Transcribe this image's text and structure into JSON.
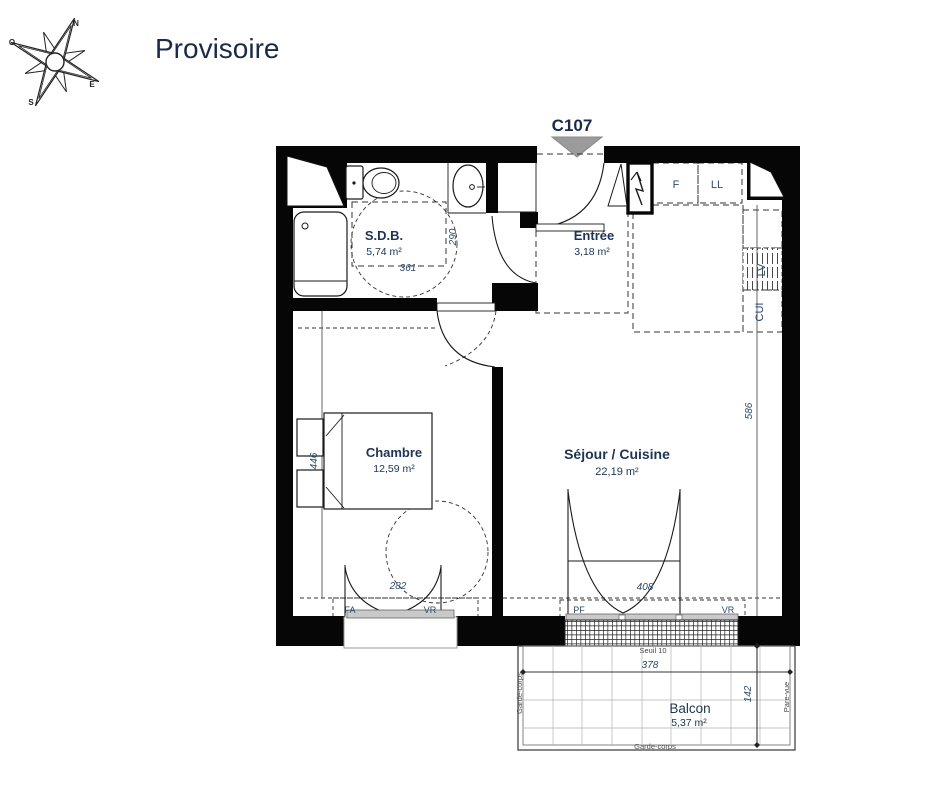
{
  "title": "Provisoire",
  "unit_label": "C107",
  "compass": {
    "n": "N",
    "e": "E",
    "s": "S",
    "o": "O"
  },
  "rooms": {
    "sdb": {
      "name": "S.D.B.",
      "area": "5,74 m²"
    },
    "entree": {
      "name": "Entrée",
      "area": "3,18 m²"
    },
    "chambre": {
      "name": "Chambre",
      "area": "12,59 m²"
    },
    "sejour": {
      "name": "Séjour / Cuisine",
      "area": "22,19 m²"
    },
    "balcon": {
      "name": "Balcon",
      "area": "5,37 m²"
    }
  },
  "appliances": {
    "fridge": "F",
    "washing_machine": "LL",
    "dishwasher": "LV",
    "kitchen_counter": "CUI"
  },
  "opening_tags": {
    "chambre_window": "FA",
    "chambre_shutter": "VR",
    "balcony_door": "PF",
    "balcony_shutter": "VR"
  },
  "dims": {
    "sdb_width": "361",
    "sdb_depth": "290",
    "chambre_depth": "446",
    "chambre_window": "282",
    "balcony_door": "408",
    "sejour_depth": "586",
    "balcony_width": "378",
    "balcony_depth": "142"
  },
  "notes": {
    "threshold": "Seuil 10",
    "guardrail_bottom": "Garde-corps",
    "guardrail_left": "Garde-corps",
    "privacy_screen": "Pare-vue"
  },
  "colors": {
    "wall": "#060606",
    "label": "#1d3452",
    "dim": "#2c4a68",
    "entry_marker": "#9b9b9b"
  }
}
